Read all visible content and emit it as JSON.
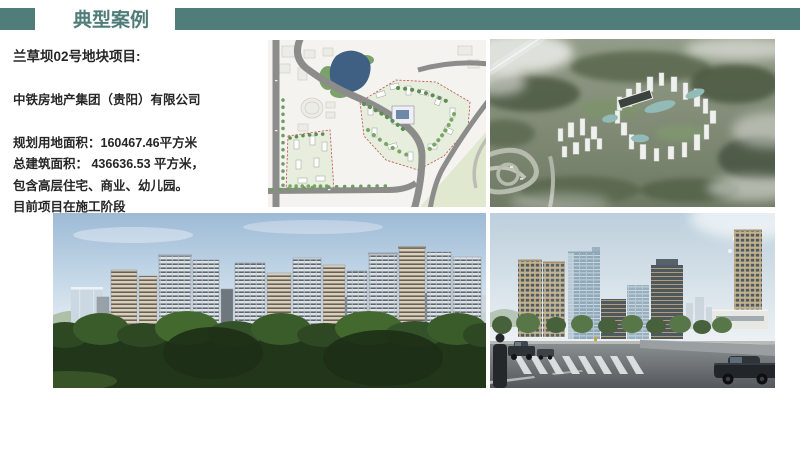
{
  "header": {
    "title": "典型案例"
  },
  "colors": {
    "accent_teal": "#507d79",
    "text": "#262626",
    "background": "#ffffff"
  },
  "project": {
    "lines": [
      "兰草坝02号地块项目:",
      "中铁房地产集团（贵阳）有限公司",
      "规划用地面积：160467.46平方米",
      "总建筑面积： 436636.53 平方米，",
      "包含高层住宅、商业、幼儿园。",
      "目前项目在施工阶段"
    ]
  }
}
